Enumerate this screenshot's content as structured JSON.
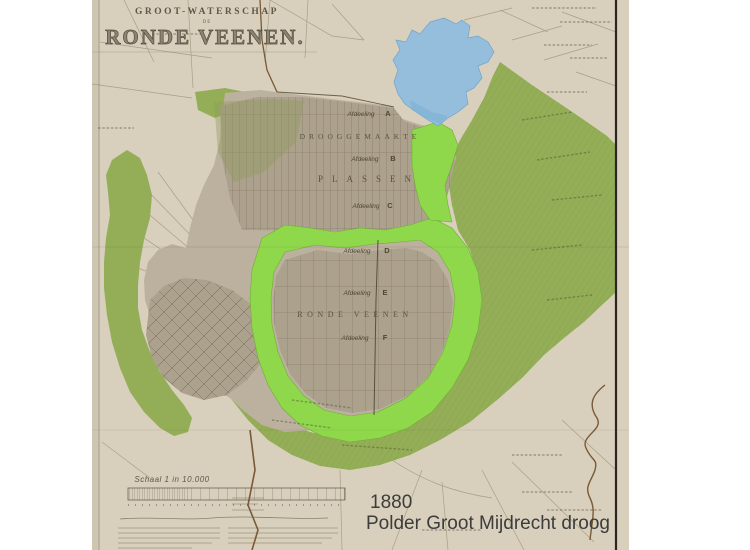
{
  "annotation": {
    "year": "1880",
    "caption": "Polder Groot Mijdrecht droog"
  },
  "map": {
    "title": {
      "over": "GROOT-WATERSCHAP",
      "de": "DE",
      "main": "RONDE VEENEN."
    },
    "areas": {
      "drooggemaakte": "DROOGGEMAAKTE",
      "plassen": "PLASSEN",
      "ronde_veenen": "RONDE VEENEN"
    },
    "afdeeling": {
      "word": "Afdeeling",
      "letters": [
        "A",
        "B",
        "C",
        "D",
        "E",
        "F"
      ]
    },
    "scale_text": "Schaal 1 in 10.000",
    "colors": {
      "paper": "#d8cfbc",
      "polder_light": "#bcb19e",
      "polder_gray": "#aca18d",
      "olive_green": "#94ae58",
      "bright_green": "#8fd84b",
      "lake_blue": "#95bedd",
      "canal_brown": "#7a5a36",
      "border_ink": "#2b2620",
      "annotation_text": "#3c3c3c"
    }
  }
}
